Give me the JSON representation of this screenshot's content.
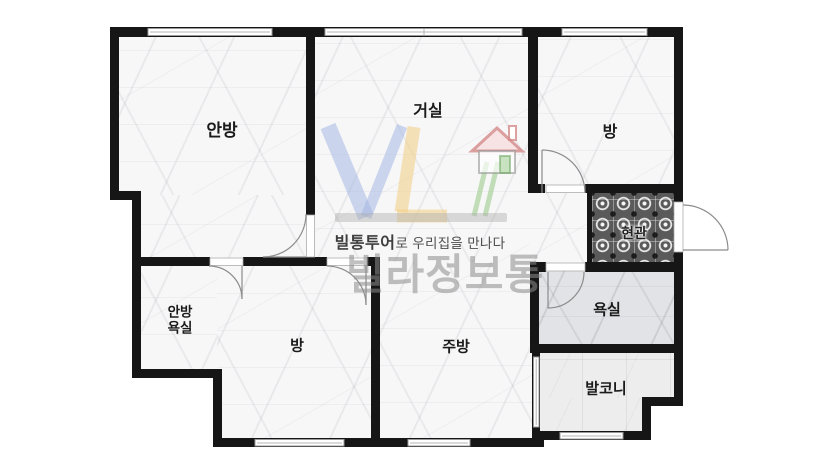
{
  "floorplan": {
    "rooms": {
      "master_bedroom": {
        "label": "안방"
      },
      "living_room": {
        "label": "거실"
      },
      "bedroom_top": {
        "label": "방"
      },
      "entrance": {
        "label": "현관"
      },
      "bathroom": {
        "label": "욕실"
      },
      "balcony": {
        "label": "발코니"
      },
      "master_bathroom": {
        "line1": "안방",
        "line2": "욕실"
      },
      "bedroom_bottom": {
        "label": "방"
      },
      "kitchen": {
        "label": "주방"
      }
    },
    "watermark": {
      "logo_icon": "vl-house-logo",
      "logo_letters": "VL",
      "tagline_bold": "빌통투어",
      "tagline_rest": "로 우리집을 만나다",
      "brand": "빌라정보통"
    },
    "colors": {
      "wall": "#161616",
      "logo_v": "#9db1e0",
      "logo_l": "#f2cd82",
      "logo_green": "#96c886",
      "logo_roof": "#d28484",
      "entrance_tile": "#5a5a5a"
    }
  }
}
